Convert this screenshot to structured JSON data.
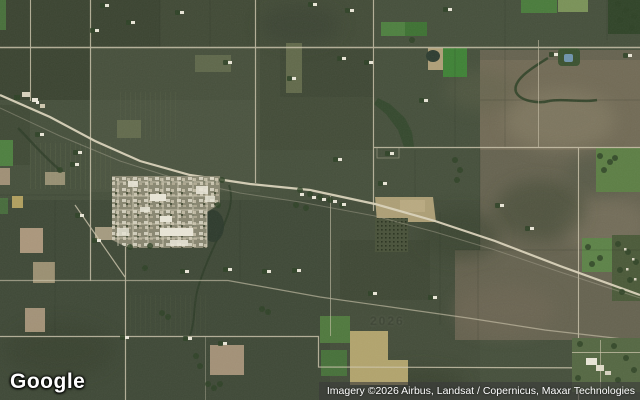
{
  "branding": {
    "logo": "Google"
  },
  "attribution": {
    "text": "Imagery ©2026 Airbus, Landsat / Copernicus, Maxar Technologies"
  },
  "map": {
    "type_label": "satellite-imagery",
    "watermark": "2026",
    "palette": {
      "base": "#46503c",
      "field_dark": "#3a4330",
      "field_olive": "#4d5641",
      "field_pale": "#666e4e",
      "brown": "#6c6653",
      "brown_light": "#837b64",
      "road": "#d0c8af",
      "highway": "#dad3ba",
      "rail": "#a8a391",
      "green_bright": "#3f8236",
      "green_mid": "#4e8040",
      "trees": "#2e4226",
      "khaki": "#b2a46d",
      "pink": "#b7a084",
      "town_base": "#969279",
      "building": "#e9e6d7",
      "water": "#2c3a2c",
      "pond_blue": "#6f94ad"
    }
  }
}
